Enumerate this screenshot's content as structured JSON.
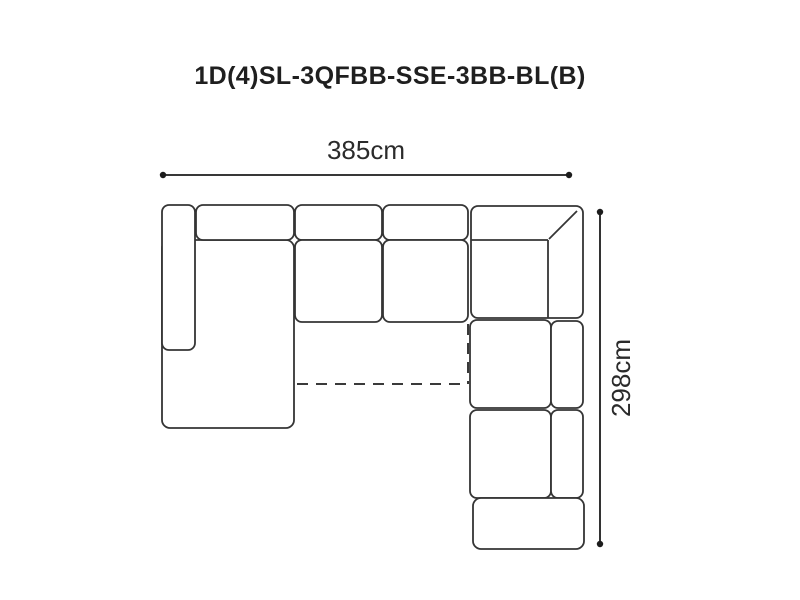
{
  "diagram": {
    "title": "1D(4)SL-3QFBB-SSE-3BB-BL(B)",
    "dimensions": {
      "width_label": "385cm",
      "height_label": "298cm"
    },
    "style": {
      "background": "#ffffff",
      "outline_color": "#353535",
      "dimension_color": "#1c1c1c",
      "text_color": "#1f1f1f"
    }
  }
}
